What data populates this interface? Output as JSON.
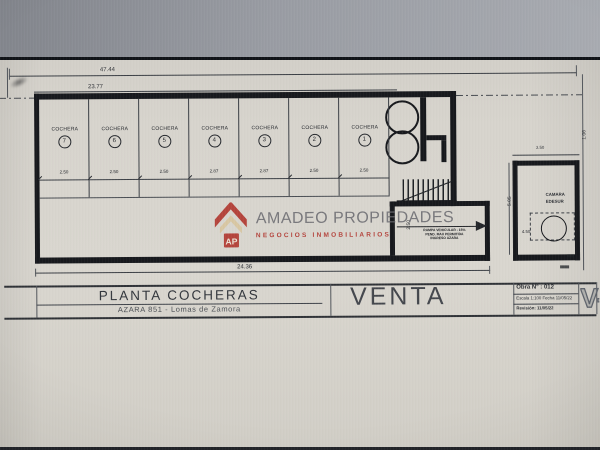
{
  "page": {
    "dim_overall": "47.44",
    "dim_building": "23.77",
    "dim_bottom": "24.36"
  },
  "stalls": {
    "label": "COCHERA",
    "items": [
      {
        "number": "7",
        "width": "2.50"
      },
      {
        "number": "6",
        "width": "2.50"
      },
      {
        "number": "5",
        "width": "2.50"
      },
      {
        "number": "4",
        "width": "2.87"
      },
      {
        "number": "3",
        "width": "2.87"
      },
      {
        "number": "2",
        "width": "2.50"
      },
      {
        "number": "1",
        "width": "2.50"
      }
    ]
  },
  "ramp": {
    "dim": "2.50",
    "note_lines": [
      "RAMPA VEHICULAR - 15%",
      "PEND. MAX PERMITIDA",
      "INGRESO AZARA"
    ]
  },
  "right_room": {
    "dim_top": "3.50",
    "dim_left": "5.05",
    "dim_inner": "4.50",
    "dim_edge": "1.06",
    "label_line1": "CAMARA",
    "label_line2": "EDESUR"
  },
  "watermark": {
    "monogram": "AP",
    "name": "AMADEO PROPIEDADES",
    "tagline": "NEGOCIOS INMOBILIARIOS",
    "red": "#b23b33",
    "cream": "#d8c6a0",
    "gray": "#6c6c71"
  },
  "titleblock": {
    "title": "PLANTA COCHERAS",
    "subtitle": "AZARA 851 - Lomas de Zamora",
    "sale": "VENTA",
    "obra": "Obra N° : 012",
    "escala": "Escala 1:100 Fecha 11/05/22",
    "revision": "Revisión: 11/05/22",
    "sheet": "V-0"
  }
}
